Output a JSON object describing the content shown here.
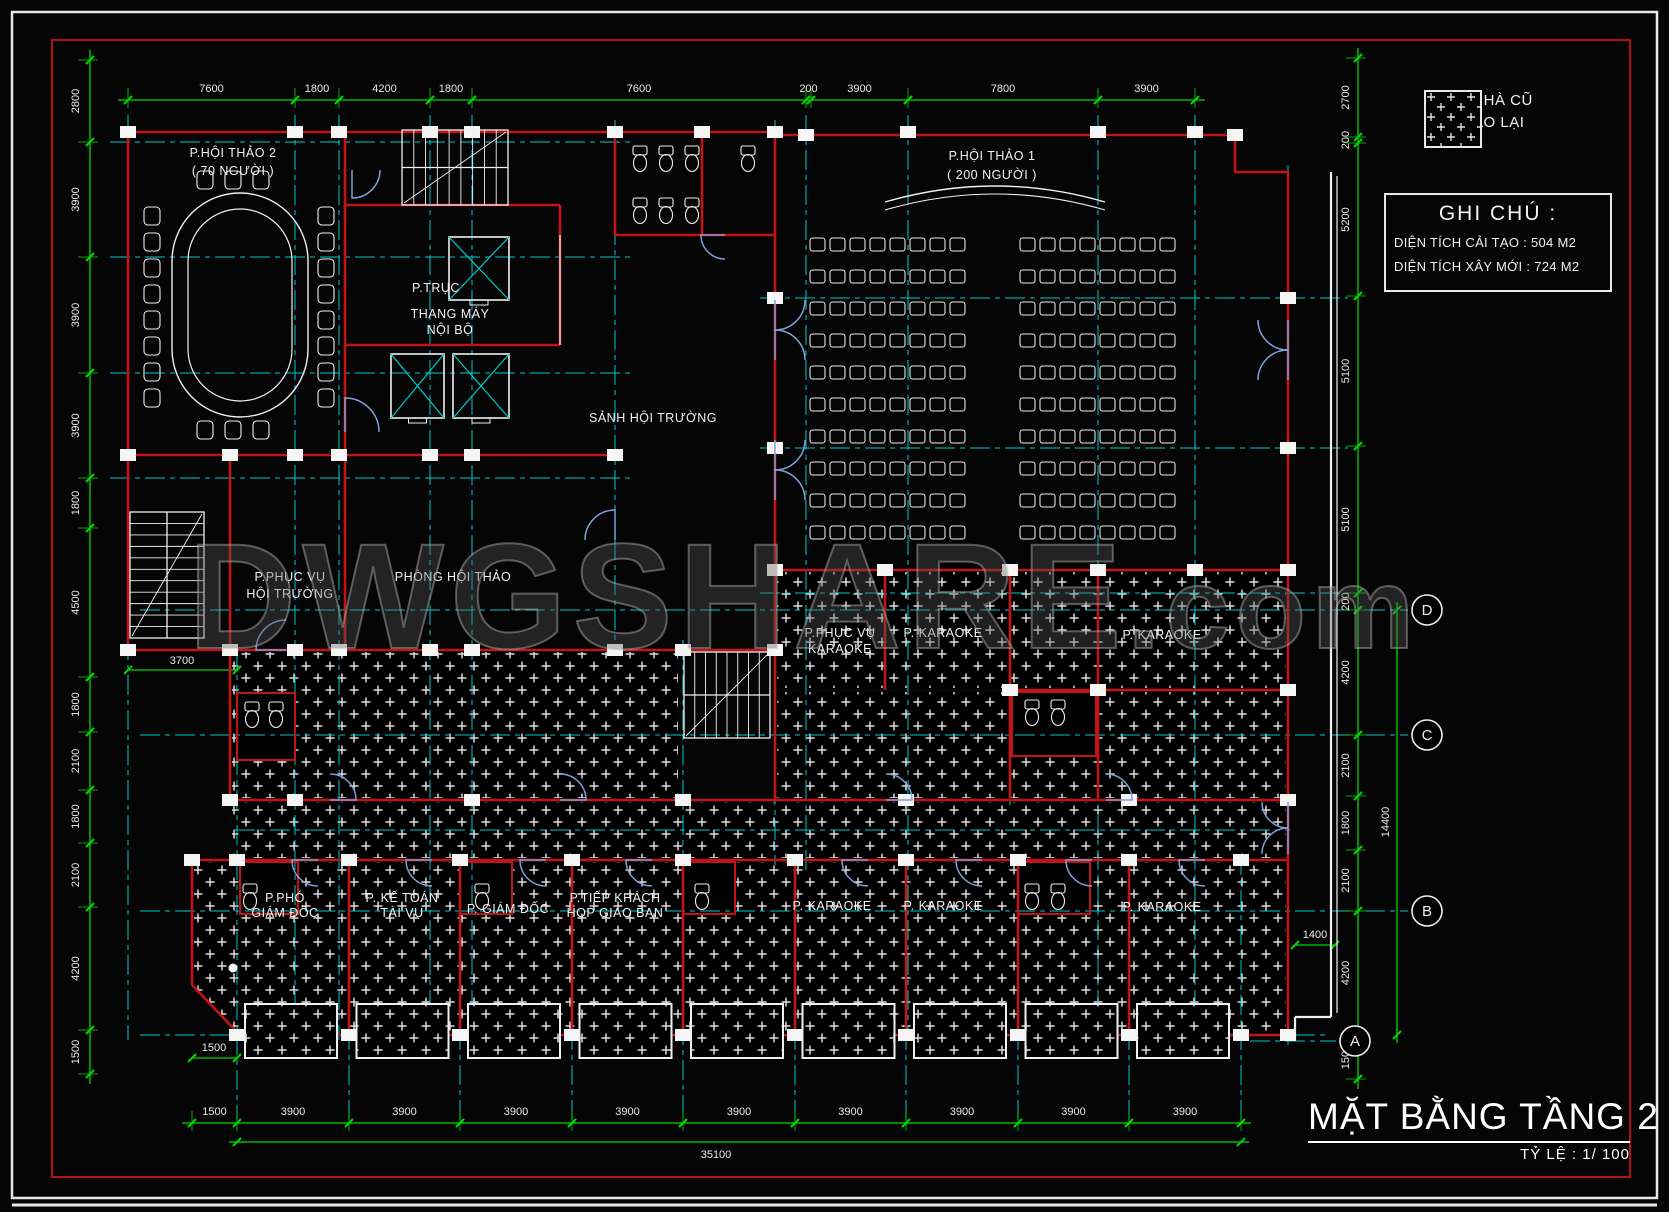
{
  "page": {
    "background": "#050505"
  },
  "colors": {
    "dimension_green": "#00d800",
    "axis_cyan": "#00c9c9",
    "wall_red": "#c31414",
    "wall_white": "#f0f0f0",
    "door_blue": "#7fa0d8",
    "text_white": "#f2f2f2"
  },
  "watermark": {
    "main": "DWGSHARE",
    "suffix": ".com"
  },
  "legend": {
    "line1": "PHẦN NHÀ CŨ",
    "line2": "CẢI TẠO LẠI",
    "swatch": "hatch-plus-pattern"
  },
  "notes": {
    "title": "GHI CHÚ :",
    "items": [
      "DIỆN TÍCH CẢI TẠO : 504 M2",
      "DIỆN TÍCH XÂY MỚI : 724 M2"
    ]
  },
  "title": {
    "text": "MẶT BẰNG TẦNG 2",
    "scale_label": "TỶ LỆ :",
    "scale_value": "1/ 100"
  },
  "axes": {
    "bubbles": [
      "D",
      "C",
      "B",
      "A"
    ]
  },
  "rooms": [
    {
      "id": "hoithao2",
      "lines": [
        "P.HỘI THẢO 2",
        "( 70 NGƯỜI )"
      ]
    },
    {
      "id": "hoithao1",
      "lines": [
        "P.HỘI THẢO 1",
        "( 200 NGƯỜI )"
      ]
    },
    {
      "id": "ptruc",
      "lines": [
        "P.TRỤC"
      ]
    },
    {
      "id": "thangmay",
      "lines": [
        "THANG MÁY",
        "NỘI BỘ"
      ]
    },
    {
      "id": "sanh",
      "lines": [
        "SẢNH HỘI TRƯỜNG"
      ]
    },
    {
      "id": "phucvu_ht",
      "lines": [
        "P.PHỤC VỤ",
        "HỘI TRƯỜNG"
      ]
    },
    {
      "id": "phong_hoithao",
      "lines": [
        "PHÒNG HỘI THẢO"
      ]
    },
    {
      "id": "phucvu_kar",
      "lines": [
        "P.PHỤC VỤ",
        "KARAOKE"
      ]
    },
    {
      "id": "kar_top_1",
      "lines": [
        "P. KARAOKE"
      ]
    },
    {
      "id": "kar_top_2",
      "lines": [
        "P. KARAOKE"
      ]
    },
    {
      "id": "pho_giamdoc",
      "lines": [
        "P.PHÓ",
        "GIÁM ĐỐC"
      ]
    },
    {
      "id": "ketoan",
      "lines": [
        "P. KẾ TOÁN",
        "TÀI VỤ"
      ]
    },
    {
      "id": "giamdoc",
      "lines": [
        "P. GIÁM ĐỐC"
      ]
    },
    {
      "id": "tiepkhach",
      "lines": [
        "P.TIẾP KHÁCH",
        "HỌP GIAO BAN"
      ]
    },
    {
      "id": "kar_bot_1",
      "lines": [
        "P. KARAOKE"
      ]
    },
    {
      "id": "kar_bot_2",
      "lines": [
        "P. KARAOKE"
      ]
    },
    {
      "id": "kar_bot_3",
      "lines": [
        "P. KARAOKE"
      ]
    }
  ],
  "dimensions": {
    "top": [
      "7600",
      "1800",
      "4200",
      "1800",
      "7600",
      "200",
      "3900",
      "7800",
      "3900"
    ],
    "left": [
      "2800",
      "3900",
      "3900",
      "3900",
      "1800",
      "4500",
      "1800",
      "2100",
      "1800",
      "2100",
      "4200",
      "1500"
    ],
    "right": [
      "2700",
      "200",
      "5200",
      "5100",
      "5100",
      "200",
      "4200",
      "2100",
      "1800",
      "2100",
      "4200",
      "1500"
    ],
    "bottom": [
      "1500",
      "3900",
      "3900",
      "3900",
      "3900",
      "3900",
      "3900",
      "3900",
      "3900",
      "3900"
    ],
    "bottom_total": "35100",
    "right_total": "14400",
    "extra": {
      "stair_bay": "3700",
      "right_step": "1400",
      "corner": "1500"
    }
  }
}
